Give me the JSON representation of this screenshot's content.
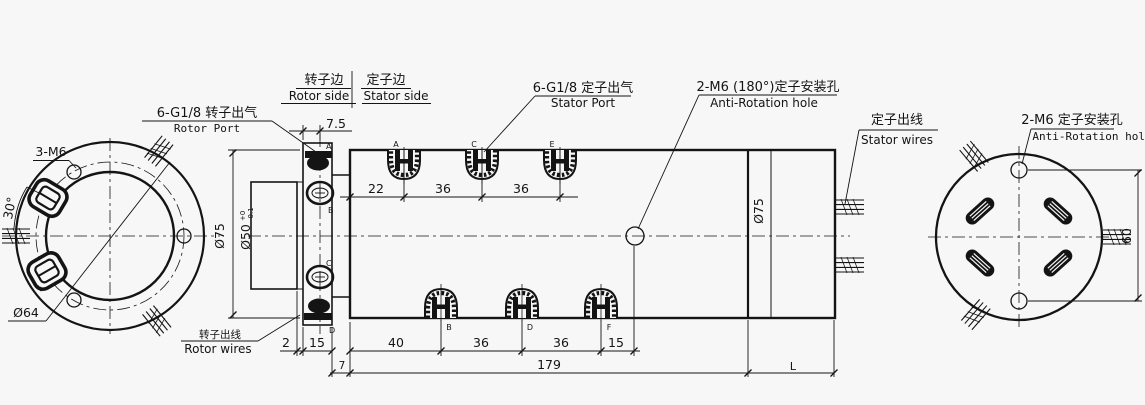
{
  "header": {
    "rotor_side_zh": "转子边",
    "rotor_side_en": "Rotor side",
    "stator_side_zh": "定子边",
    "stator_side_en": "Stator side"
  },
  "callouts": {
    "rotor_port_zh": "6-G1/8 转子出气",
    "rotor_port_en": "Rotor Port",
    "stator_port_zh": "6-G1/8 定子出气",
    "stator_port_en": "Stator Port",
    "anti_rotation_180_zh": "2-M6 (180°)定子安装孔",
    "anti_rotation_180_en": "Anti-Rotation hole",
    "stator_wires_zh": "定子出线",
    "stator_wires_en": "Stator wires",
    "anti_rotation_2m6_zh": "2-M6 定子安装孔",
    "anti_rotation_2m6_en": "Anti-Rotation hole",
    "rotor_wires_zh": "转子出线",
    "rotor_wires_en": "Rotor wires",
    "bolt_holes": "3-M6"
  },
  "dimensions": {
    "flange_port_offset": "7.5",
    "top_spacing": [
      "22",
      "36",
      "36"
    ],
    "bottom_spacing": [
      "2",
      "15",
      "40",
      "36",
      "36",
      "15"
    ],
    "length_row": [
      "7",
      "179",
      "L"
    ],
    "body_dia_left": "Ø75",
    "boss_dia": "Ø50",
    "boss_tol_plus": "+0",
    "boss_tol_minus": "-0.1",
    "body_dia_mid": "Ø75",
    "bolt_circle_dia": "Ø64",
    "port_angle": "30°",
    "hole_spacing": "60"
  },
  "port_letters": {
    "flange": [
      "A",
      "B",
      "C",
      "D"
    ],
    "body_top": [
      "A",
      "C",
      "E"
    ],
    "body_bottom": [
      "B",
      "D",
      "F"
    ],
    "face_view": [
      "F",
      "E"
    ]
  }
}
